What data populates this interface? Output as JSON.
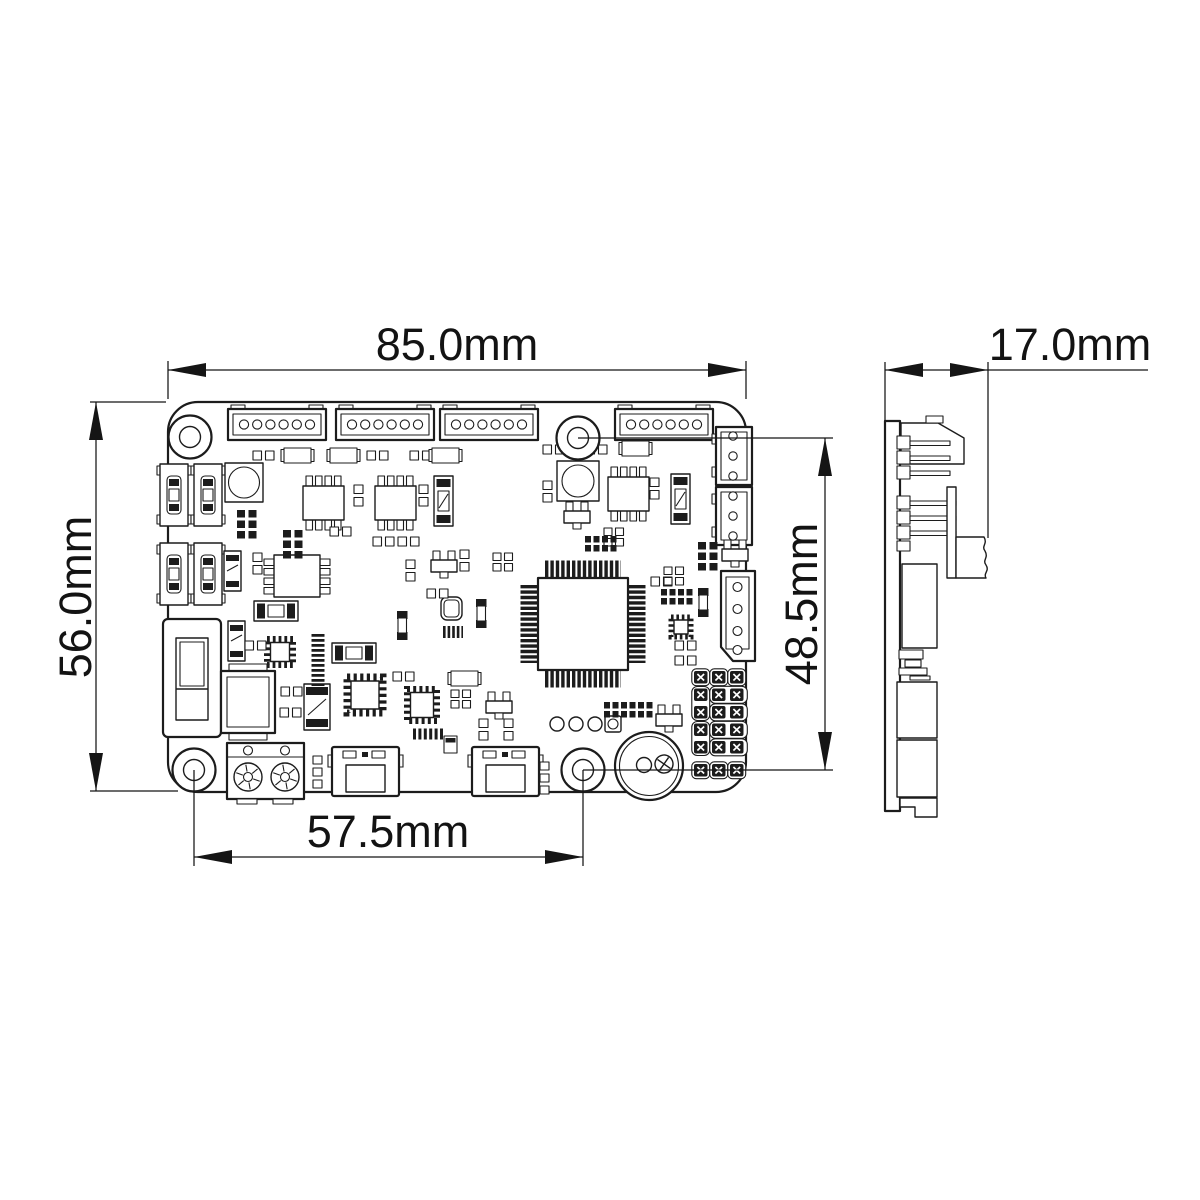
{
  "drawing": {
    "subject": "PCB control board dimensional drawing",
    "views": [
      "front",
      "side"
    ],
    "background_color": "#ffffff",
    "line_color": "#1c1c1c"
  },
  "dims": {
    "board_width": "85.0mm",
    "board_height": "56.0mm",
    "hole_spacing_horizontal": "57.5mm",
    "hole_spacing_vertical": "48.5mm",
    "side_width": "17.0mm"
  }
}
